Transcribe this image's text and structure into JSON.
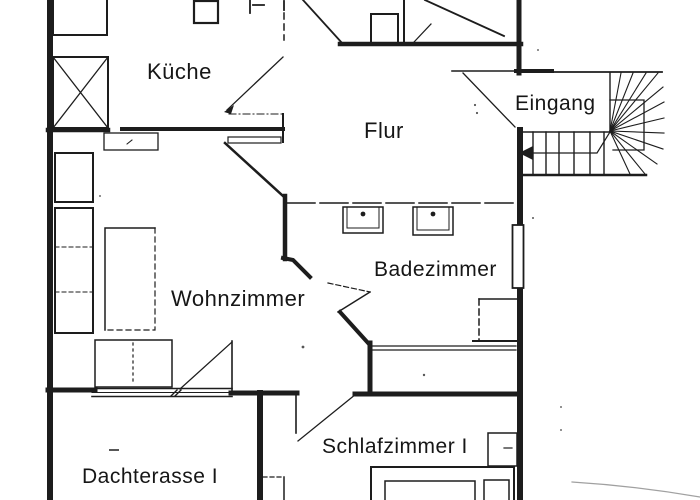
{
  "plan": {
    "rooms": [
      {
        "id": "kueche",
        "label": "Küche"
      },
      {
        "id": "flur",
        "label": "Flur"
      },
      {
        "id": "eingang",
        "label": "Eingang"
      },
      {
        "id": "wohnzimmer",
        "label": "Wohnzimmer"
      },
      {
        "id": "badezimmer",
        "label": "Badezimmer"
      },
      {
        "id": "schlafzimmer_1",
        "label": "Schlafzimmer I"
      },
      {
        "id": "dachterasse_1",
        "label": "Dachterasse I"
      }
    ],
    "stairs": {
      "direction_arrow": "left"
    },
    "colors": {
      "ink": "#1d1d1d",
      "paper": "#ffffff"
    }
  }
}
